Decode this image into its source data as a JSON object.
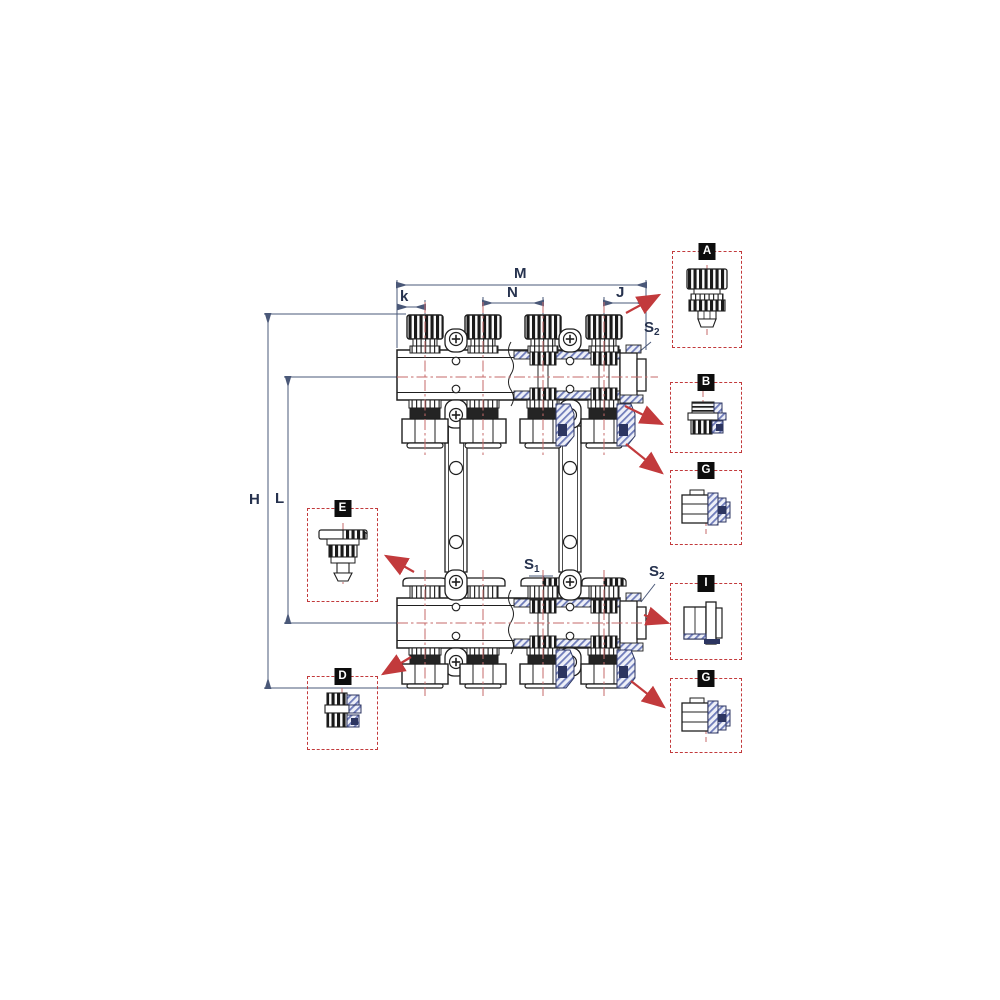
{
  "diagram": {
    "description": "Sectional technical drawing of a heating distribution manifold pair with thermostatic valve inserts, shut-off caps, mounting brackets and detail callouts",
    "dimension_labels": {
      "overall_width": "M",
      "left_offset": "k",
      "outlet_pitch": "N",
      "right_offset": "J",
      "overall_height": "H",
      "axis_distance": "L"
    },
    "wrench_labels": {
      "s_letter": "S",
      "s1_index": "1",
      "s2_index": "2"
    },
    "callouts": [
      {
        "letter": "A"
      },
      {
        "letter": "B"
      },
      {
        "letter": "G"
      },
      {
        "letter": "I"
      },
      {
        "letter": "G"
      },
      {
        "letter": "E"
      },
      {
        "letter": "D"
      }
    ],
    "colors": {
      "linework": "#1f1f1f",
      "dimension_lines": "#4a5878",
      "callout_red": "#c23a3c",
      "centerline_red": "#c66a6a",
      "section_hatch_blue": "#6f7cba",
      "chip_background": "#0d0d0d",
      "chip_text": "#ffffff"
    }
  }
}
